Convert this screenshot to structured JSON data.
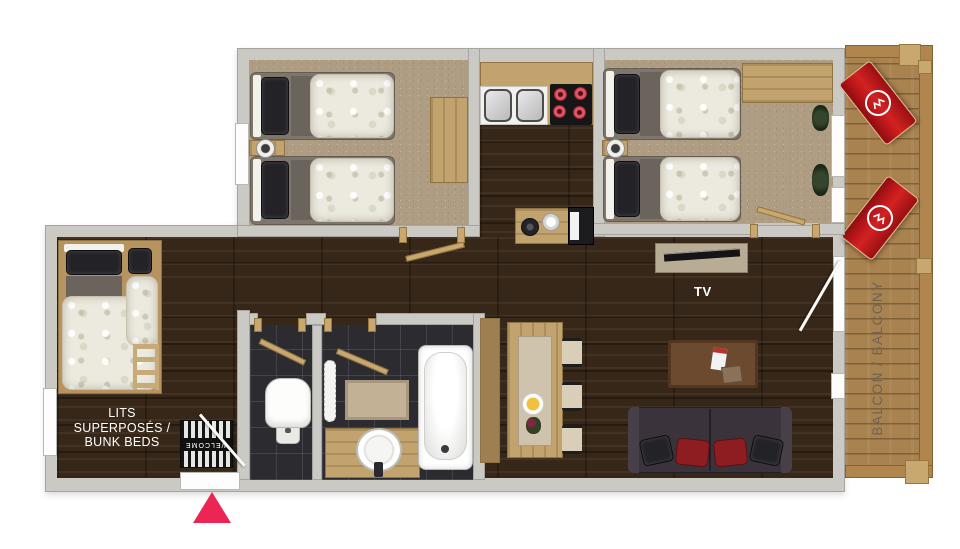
{
  "plan": {
    "type": "apartment-floor-plan",
    "labels": {
      "bunk_line1": "LITS",
      "bunk_line2": "SUPERPOSÉS /",
      "bunk_line3": "BUNK BEDS",
      "tv": "TV",
      "balcony": "BALCON / BALCONY",
      "welcome": "WELCOME"
    },
    "colors": {
      "entrance_arrow": "#ed2553",
      "lounge_chair_red": "#b01318",
      "hob_burner_red": "#d6465a",
      "wall_gray": "#cbc9c4",
      "carpet_beige": "#ae9d82",
      "dark_wood_floor": "#372718",
      "balcony_deck_wood": "#a8824f",
      "bathroom_tile": "#2b2b30"
    }
  }
}
